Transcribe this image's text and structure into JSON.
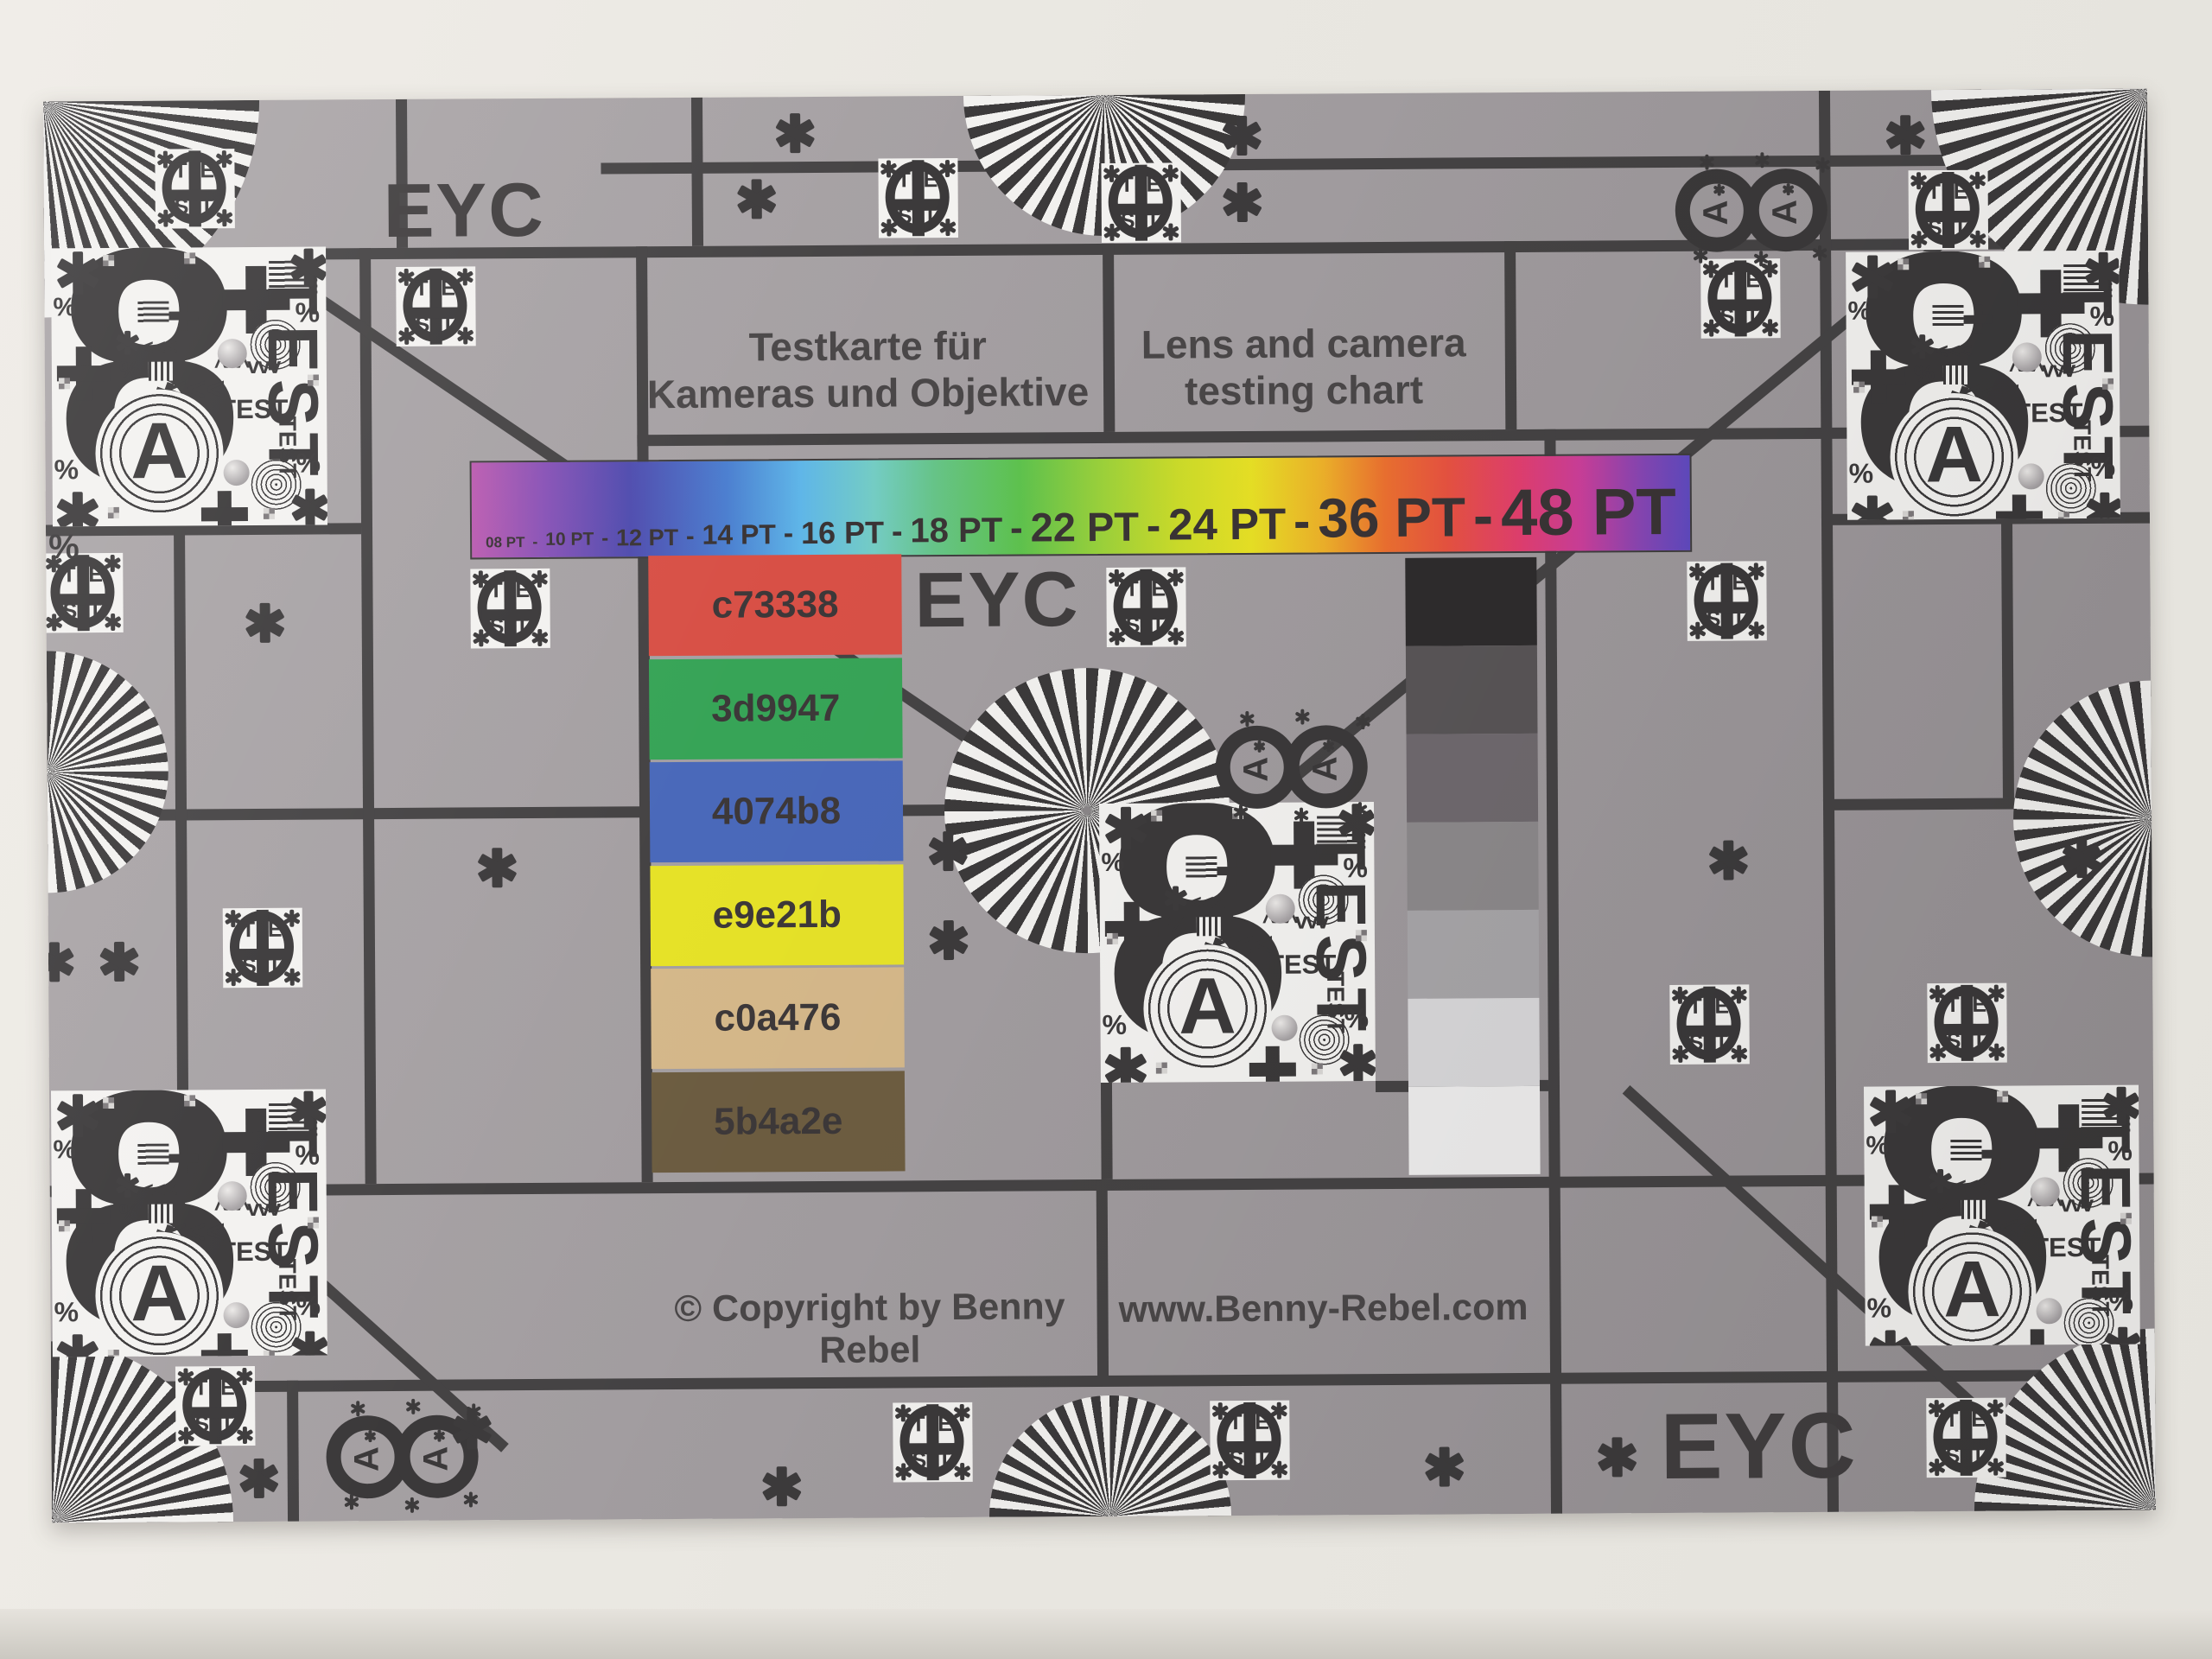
{
  "texts": {
    "eyc": "EYC"
  },
  "titles": {
    "de_line1": "Testkarte für",
    "de_line2": "Kameras und Objektive",
    "en_line1": "Lens and camera",
    "en_line2": "testing chart"
  },
  "font_bar": {
    "items": [
      {
        "text": "08 PT"
      },
      {
        "text": "-"
      },
      {
        "text": "10 PT"
      },
      {
        "text": "-"
      },
      {
        "text": "12 PT"
      },
      {
        "text": "-"
      },
      {
        "text": "14 PT"
      },
      {
        "text": "-"
      },
      {
        "text": "16 PT"
      },
      {
        "text": "-"
      },
      {
        "text": "18 PT"
      },
      {
        "text": "-"
      },
      {
        "text": "22 PT"
      },
      {
        "text": "-"
      },
      {
        "text": "24 PT"
      },
      {
        "text": "-"
      },
      {
        "text": "36 PT"
      },
      {
        "text": "-"
      },
      {
        "text": "48 PT"
      }
    ]
  },
  "patches": [
    {
      "label": "c73338",
      "color": "#d85046"
    },
    {
      "label": "3d9947",
      "color": "#37a457"
    },
    {
      "label": "4074b8",
      "color": "#4a69ba"
    },
    {
      "label": "e9e21b",
      "color": "#e6e228"
    },
    {
      "label": "c0a476",
      "color": "#d5b88a"
    },
    {
      "label": "5b4a2e",
      "color": "#6d5d41"
    }
  ],
  "grayscale_steps": [
    "#2e2c2d",
    "#595557",
    "#6f696e",
    "#8c898b",
    "#a7a5a8",
    "#d8d7d9",
    "#edecec"
  ],
  "rainbow_gradient": [
    {
      "p": 0,
      "c": "#bb5cb0"
    },
    {
      "p": 6,
      "c": "#8852b6"
    },
    {
      "p": 13,
      "c": "#4f4cae"
    },
    {
      "p": 21,
      "c": "#4b7fd0"
    },
    {
      "p": 27,
      "c": "#5fb6e8"
    },
    {
      "p": 33,
      "c": "#74ccc4"
    },
    {
      "p": 38,
      "c": "#66c488"
    },
    {
      "p": 45,
      "c": "#5ec24e"
    },
    {
      "p": 52,
      "c": "#9ed23a"
    },
    {
      "p": 58,
      "c": "#ccdc2a"
    },
    {
      "p": 64,
      "c": "#e8e125"
    },
    {
      "p": 70,
      "c": "#eeb02a"
    },
    {
      "p": 75,
      "c": "#ec7030"
    },
    {
      "p": 80,
      "c": "#e85340"
    },
    {
      "p": 86,
      "c": "#e23f6f"
    },
    {
      "p": 91,
      "c": "#cc3f9a"
    },
    {
      "p": 96,
      "c": "#8746b4"
    },
    {
      "p": 100,
      "c": "#5f4ac0"
    }
  ],
  "footer": {
    "copyright": "© Copyright by Benny Rebel",
    "website": "www.Benny-Rebel.com"
  },
  "glyphs": {
    "digit_eight": "8",
    "letter_a": "A",
    "test_word": "TEST",
    "test_letters": [
      "T",
      "E",
      "S",
      "T"
    ],
    "arrows_left": "<<<",
    "arrows_up": "^^^",
    "arrows_down": "vvv",
    "percent": "%"
  },
  "colors": {
    "card_gray": "#a29da0",
    "grid_line": "#454344",
    "ink": "#3b393a",
    "paper_white": "#f3f2f0"
  }
}
